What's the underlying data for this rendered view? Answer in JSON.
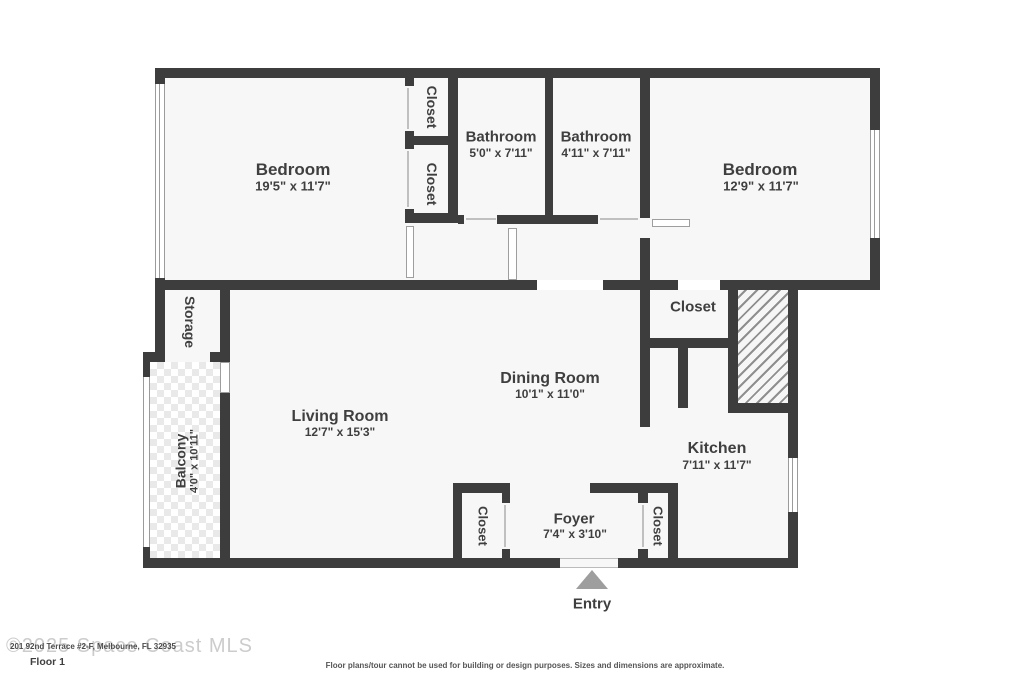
{
  "colors": {
    "wall": "#3d3d3d",
    "floor_fill": "#f7f7f7",
    "label_text": "#3f3f3f",
    "watermark": "#cccccc",
    "entry_arrow": "#9e9e9e"
  },
  "rooms": {
    "bedroom_left": {
      "name": "Bedroom",
      "dims": "19'5\" x 11'7\""
    },
    "closet_top_a": {
      "name": "Closet"
    },
    "closet_top_b": {
      "name": "Closet"
    },
    "bathroom_left": {
      "name": "Bathroom",
      "dims": "5'0\" x 7'11\""
    },
    "bathroom_right": {
      "name": "Bathroom",
      "dims": "4'11\" x 7'11\""
    },
    "bedroom_right": {
      "name": "Bedroom",
      "dims": "12'9\" x 11'7\""
    },
    "closet_bedroom_right": {
      "name": "Closet"
    },
    "storage": {
      "name": "Storage"
    },
    "dining_room": {
      "name": "Dining Room",
      "dims": "10'1\" x 11'0\""
    },
    "living_room": {
      "name": "Living Room",
      "dims": "12'7\" x 15'3\""
    },
    "balcony": {
      "name": "Balcony",
      "dims": "4'0\" x 10'11\""
    },
    "kitchen": {
      "name": "Kitchen",
      "dims": "7'11\" x 11'7\""
    },
    "foyer": {
      "name": "Foyer",
      "dims": "7'4\" x 3'10\""
    },
    "closet_foyer_left": {
      "name": "Closet"
    },
    "closet_foyer_right": {
      "name": "Closet"
    }
  },
  "entry": {
    "label": "Entry"
  },
  "footer": {
    "watermark": "©2025 Space Coast MLS",
    "address": "201 92nd Terrace #2-F, Melbourne, FL 32935",
    "floor_label": "Floor 1",
    "disclaimer": "Floor plans/tour cannot be used for building or design purposes. Sizes and dimensions are approximate."
  }
}
